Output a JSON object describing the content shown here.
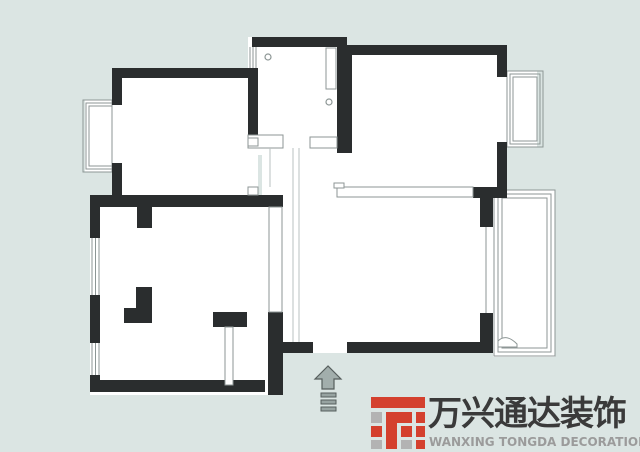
{
  "colors": {
    "background": "#dbe5e3",
    "wall": "#2a2d2e",
    "floor": "#ffffff",
    "thin_stroke": "#8d9695",
    "faint_line": "#b9c2c0",
    "arrow_fill": "#a2aeac",
    "arrow_stroke": "#565e5d",
    "step_fill": "#97a3a1",
    "logo_red": "#d4402e",
    "logo_gray": "#b3b3b3",
    "logo_title_color": "#3a3a3a",
    "logo_subtitle_color": "#9b9b9b"
  },
  "logo": {
    "title": "万兴通达装饰",
    "subtitle": "WANXING TONGDA DECORATION",
    "icon_blocks": [
      {
        "x": 0,
        "y": 0,
        "w": 54,
        "h": 11,
        "c": "red"
      },
      {
        "x": 0,
        "y": 15,
        "w": 11,
        "h": 11,
        "c": "gray"
      },
      {
        "x": 0,
        "y": 29,
        "w": 11,
        "h": 11,
        "c": "red"
      },
      {
        "x": 0,
        "y": 43,
        "w": 11,
        "h": 9,
        "c": "gray"
      },
      {
        "x": 15,
        "y": 15,
        "w": 11,
        "h": 37,
        "c": "red"
      },
      {
        "x": 15,
        "y": 15,
        "w": 26,
        "h": 11,
        "c": "red"
      },
      {
        "x": 30,
        "y": 29,
        "w": 11,
        "h": 11,
        "c": "red"
      },
      {
        "x": 30,
        "y": 43,
        "w": 11,
        "h": 9,
        "c": "gray"
      },
      {
        "x": 45,
        "y": 15,
        "w": 9,
        "h": 11,
        "c": "red"
      },
      {
        "x": 45,
        "y": 29,
        "w": 9,
        "h": 11,
        "c": "red"
      },
      {
        "x": 45,
        "y": 43,
        "w": 9,
        "h": 9,
        "c": "red"
      }
    ]
  },
  "plan": {
    "floors": [
      [
        248,
        37,
        99,
        118
      ],
      [
        112,
        68,
        146,
        139
      ],
      [
        343,
        45,
        164,
        153
      ],
      [
        262,
        135,
        235,
        218
      ],
      [
        90,
        195,
        193,
        200
      ],
      [
        85,
        100,
        27,
        72
      ],
      [
        507,
        71,
        30,
        76
      ],
      [
        493,
        190,
        62,
        167
      ]
    ],
    "walls": [
      [
        112,
        68,
        146,
        10
      ],
      [
        112,
        78,
        10,
        27
      ],
      [
        112,
        163,
        10,
        44
      ],
      [
        90,
        195,
        193,
        12
      ],
      [
        248,
        78,
        10,
        60
      ],
      [
        252,
        37,
        95,
        10
      ],
      [
        337,
        47,
        15,
        106
      ],
      [
        343,
        45,
        164,
        10
      ],
      [
        497,
        55,
        10,
        22
      ],
      [
        497,
        142,
        10,
        50
      ],
      [
        473,
        187,
        34,
        11
      ],
      [
        480,
        198,
        13,
        29
      ],
      [
        480,
        313,
        13,
        40
      ],
      [
        347,
        342,
        133,
        11
      ],
      [
        283,
        342,
        30,
        11
      ],
      [
        268,
        312,
        15,
        83
      ],
      [
        90,
        207,
        10,
        31
      ],
      [
        90,
        295,
        10,
        48
      ],
      [
        90,
        375,
        10,
        17
      ],
      [
        90,
        380,
        175,
        12
      ],
      [
        137,
        207,
        15,
        21
      ],
      [
        136,
        287,
        16,
        23
      ],
      [
        124,
        308,
        28,
        15
      ],
      [
        213,
        312,
        34,
        15
      ]
    ],
    "thin_walls": [
      [
        269,
        207,
        13,
        105
      ],
      [
        337,
        187,
        136,
        10
      ],
      [
        248,
        135,
        35,
        13
      ],
      [
        310,
        137,
        27,
        11
      ],
      [
        225,
        327,
        8,
        58
      ],
      [
        326,
        48,
        10,
        41
      ],
      [
        334,
        183,
        10,
        5
      ],
      [
        248,
        138,
        10,
        8
      ],
      [
        248,
        187,
        10,
        8
      ]
    ],
    "window_outlines": [
      [
        83,
        100,
        29,
        72
      ],
      [
        86,
        103,
        26,
        66
      ],
      [
        89,
        106,
        23,
        60
      ],
      [
        507,
        71,
        36,
        76
      ],
      [
        510,
        74,
        30,
        70
      ],
      [
        513,
        77,
        24,
        64
      ],
      [
        494,
        190,
        61,
        166
      ],
      [
        498,
        194,
        53,
        158
      ],
      [
        502,
        198,
        45,
        150
      ]
    ],
    "window_lines": [
      [
        250,
        47,
        250,
        68
      ],
      [
        253,
        47,
        253,
        68
      ],
      [
        256,
        47,
        256,
        68
      ],
      [
        92,
        238,
        92,
        295
      ],
      [
        95.5,
        238,
        95.5,
        295
      ],
      [
        99,
        238,
        99,
        295
      ],
      [
        92,
        343,
        92,
        375
      ],
      [
        95.5,
        343,
        95.5,
        375
      ],
      [
        99,
        343,
        99,
        375
      ],
      [
        486,
        227,
        486,
        313
      ]
    ],
    "faint_lines": [
      [
        293,
        148,
        293,
        342
      ],
      [
        299,
        148,
        299,
        342
      ],
      [
        270,
        148,
        270,
        187
      ]
    ],
    "circles": [
      [
        268,
        57,
        3
      ],
      [
        329,
        102,
        3
      ]
    ],
    "door_swing": "M498,347 L517,347 L517,344 Q506,333 498,341 Z",
    "entrance": {
      "arrow_points": "328,366 315,379 322,379 322,389 334,389 334,379 341,379",
      "steps": [
        [
          321,
          393,
          15,
          4
        ],
        [
          321,
          400,
          15,
          4
        ],
        [
          321,
          407,
          15,
          4
        ]
      ]
    }
  }
}
